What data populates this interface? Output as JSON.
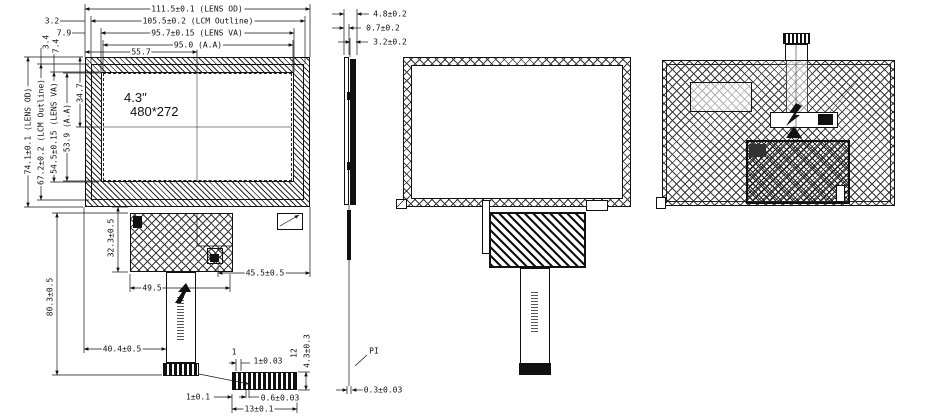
{
  "drawing": {
    "front": {
      "size_label": "4.3\"",
      "res_label": "480*272",
      "dim_top": [
        "111.5±0.1 (LENS OD)",
        "105.5±0.2 (LCM Outline)",
        "95.7±0.15 (LENS VA)",
        "95.0 (A.A)",
        "55.7",
        "3.2",
        "7.9"
      ],
      "dim_left": [
        "74.1±0.1 (LENS OD)",
        "67.2±0.2 (LCM Outline)",
        "54.5±0.15 (LENS VA)",
        "53.9 (A.A)",
        "34.7",
        "3.4",
        "7.4"
      ],
      "dim_bottom": {
        "pcb_height": "32.3±0.5",
        "connector_offset": "45.5±0.5",
        "pcb_width": "49.5",
        "fpc_length": "80.3±0.5",
        "fpc_offset": "40.4±0.5"
      }
    },
    "detail": {
      "pin_first": "1",
      "pin_last": "12",
      "pitch": "1±0.03",
      "height": "4.3±0.3",
      "margin": "1±0.1",
      "finger_width": "0.6±0.03",
      "total_width": "13±0.1"
    },
    "side": {
      "total_thickness": "4.8±0.2",
      "lens_thickness": "0.7±0.2",
      "module_thickness": "3.2±0.2",
      "fpc_thickness": "0.3±0.03",
      "film_label": "PI"
    },
    "line_color": "#111111",
    "background": "#ffffff"
  }
}
